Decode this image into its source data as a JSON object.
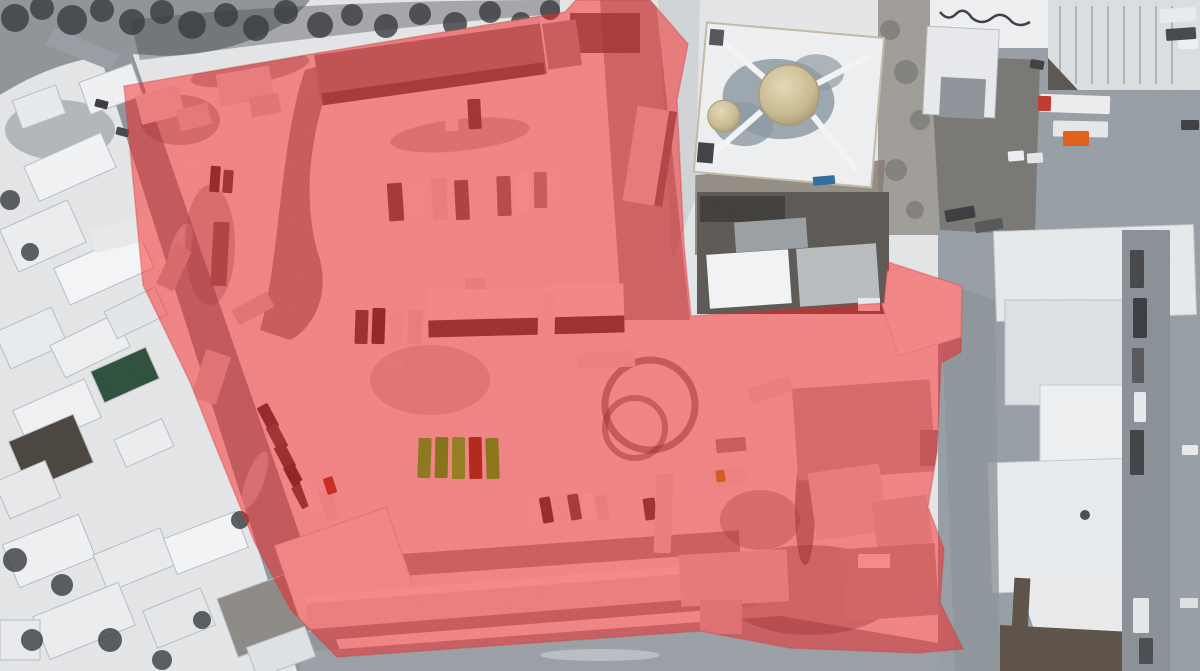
{
  "scene": {
    "kind": "aerial-drone-photo",
    "season": "winter-snow",
    "subject": "snow-covered vehicle depot compound highlighted with a red polygon overlay; mosque with tan dome at top, residential houses left, industrial warehouses right"
  },
  "annotation": {
    "zones": [
      {
        "id": "main-compound",
        "shape": "polygon",
        "color": "#ff1414",
        "edge": "#d03535",
        "opacity": 0.47,
        "points": "124,86 300,56 565,12 576,0 650,0 688,44 677,100 684,245 691,316 884,303 888,262 962,286 961,352 941,363 937,452 928,507 944,549 940,602 963,649 918,653 790,648 700,631 337,657 291,610 255,543 213,440 190,382 143,285"
      }
    ]
  },
  "palette": {
    "snow": "#e4e6e8",
    "road": "#8f969c",
    "roof_white": "#f0f2f4",
    "roof_gray": "#b9bdc0",
    "roof_dark": "#4a443e",
    "roof_green": "#2c4f3a",
    "dome_tan": "#cdbf9a",
    "tree_dark": "#35383c",
    "courtyard_brown": "#7b7267",
    "olive_truck": "#8c7720",
    "red_vehicle": "#cc2a1e",
    "orange_truck": "#e06018"
  },
  "vehicles": {
    "under": [
      [
        388,
        183,
        15,
        38,
        -4,
        "#56565a"
      ],
      [
        410,
        180,
        16,
        40,
        -4,
        "#e9e9eb"
      ],
      [
        432,
        178,
        15,
        42,
        -3,
        "#d8d8da"
      ],
      [
        455,
        180,
        14,
        40,
        -3,
        "#66666a"
      ],
      [
        476,
        178,
        15,
        42,
        -2,
        "#e4e4e6"
      ],
      [
        497,
        176,
        14,
        40,
        -2,
        "#77777b"
      ],
      [
        516,
        174,
        13,
        38,
        -2,
        "#ededef"
      ],
      [
        534,
        172,
        13,
        36,
        -1,
        "#98989c"
      ],
      [
        552,
        170,
        12,
        34,
        -1,
        "#e8e8ea"
      ],
      [
        445,
        103,
        13,
        28,
        -3,
        "#e6e6e8"
      ],
      [
        468,
        99,
        13,
        30,
        -3,
        "#4e4e52"
      ],
      [
        355,
        310,
        13,
        34,
        2,
        "#46464a"
      ],
      [
        372,
        308,
        13,
        36,
        2,
        "#343438"
      ],
      [
        390,
        312,
        13,
        32,
        2,
        "#e0e0e2"
      ],
      [
        408,
        310,
        14,
        34,
        2,
        "#d8d8da"
      ],
      [
        385,
        356,
        18,
        11,
        -4,
        "#cdcdcf"
      ],
      [
        538,
        293,
        17,
        44,
        1,
        "#e6e6e8"
      ],
      [
        577,
        352,
        58,
        16,
        -3,
        "#dededf"
      ],
      [
        262,
        404,
        12,
        26,
        -28,
        "#3a3a3e"
      ],
      [
        271,
        424,
        12,
        26,
        -28,
        "#4a4a4e"
      ],
      [
        279,
        444,
        12,
        26,
        -28,
        "#404044"
      ],
      [
        288,
        464,
        12,
        25,
        -28,
        "#2e2e32"
      ],
      [
        296,
        484,
        12,
        24,
        -28,
        "#46464a"
      ],
      [
        305,
        478,
        13,
        34,
        -20,
        "#eaeaec"
      ],
      [
        322,
        490,
        13,
        30,
        -20,
        "#dcdcde"
      ],
      [
        527,
        499,
        11,
        26,
        -10,
        "#e8e8ea"
      ],
      [
        541,
        497,
        11,
        26,
        -10,
        "#3c3c40"
      ],
      [
        555,
        495,
        11,
        26,
        -10,
        "#e2e2e4"
      ],
      [
        569,
        494,
        11,
        26,
        -10,
        "#58585c"
      ],
      [
        583,
        494,
        11,
        26,
        -10,
        "#eceef0"
      ],
      [
        597,
        495,
        11,
        25,
        -10,
        "#d8d8da"
      ],
      [
        630,
        500,
        12,
        22,
        -8,
        "#e6e6e8"
      ],
      [
        644,
        498,
        12,
        22,
        -8,
        "#48484c"
      ],
      [
        655,
        473,
        17,
        80,
        2,
        "#d9d9db"
      ],
      [
        712,
        468,
        34,
        18,
        -8,
        "#e0e0e2"
      ],
      [
        716,
        438,
        30,
        14,
        -5,
        "#9a9a9e"
      ],
      [
        748,
        382,
        44,
        16,
        -18,
        "#dadadc"
      ],
      [
        198,
        352,
        26,
        50,
        18,
        "#c9c9cb"
      ],
      [
        185,
        160,
        16,
        10,
        0,
        "#e8e8ea"
      ],
      [
        210,
        166,
        10,
        26,
        4,
        "#3a3a3e"
      ],
      [
        223,
        170,
        10,
        23,
        4,
        "#4c4c50"
      ],
      [
        212,
        222,
        16,
        64,
        3,
        "#6a6a6e"
      ],
      [
        233,
        300,
        40,
        17,
        -28,
        "#c8c8ca"
      ],
      [
        152,
        258,
        44,
        19,
        -65,
        "#b6b6b8"
      ]
    ],
    "accent": [
      [
        418,
        438,
        13,
        40,
        2,
        "#8c7720"
      ],
      [
        435,
        437,
        13,
        41,
        1,
        "#877218"
      ],
      [
        452,
        437,
        13,
        42,
        0,
        "#947f1f"
      ],
      [
        469,
        437,
        13,
        42,
        -1,
        "#b2271a"
      ],
      [
        486,
        438,
        13,
        41,
        -2,
        "#8a7519"
      ],
      [
        325,
        477,
        10,
        17,
        -18,
        "#cc2a1e"
      ],
      [
        716,
        470,
        9,
        12,
        -8,
        "#d4581e"
      ]
    ],
    "outside": [
      [
        92,
        222,
        62,
        24,
        -14,
        "#e9eaec"
      ],
      [
        1040,
        95,
        70,
        18,
        2,
        "#eceef0"
      ],
      [
        1038,
        96,
        13,
        15,
        2,
        "#c0392b"
      ],
      [
        1053,
        121,
        55,
        16,
        1,
        "#e6e8ea"
      ],
      [
        1063,
        131,
        26,
        15,
        0,
        "#e06018"
      ],
      [
        1008,
        151,
        16,
        10,
        -4,
        "#eef0f2"
      ],
      [
        1027,
        153,
        16,
        10,
        -4,
        "#e4e6e8"
      ],
      [
        1030,
        60,
        14,
        9,
        10,
        "#3e4044"
      ],
      [
        945,
        208,
        30,
        12,
        -10,
        "#3a3c40"
      ],
      [
        975,
        220,
        28,
        11,
        -10,
        "#54565a"
      ],
      [
        1130,
        250,
        14,
        38,
        0,
        "#44464a"
      ],
      [
        1133,
        298,
        14,
        40,
        0,
        "#3a3c40"
      ],
      [
        1132,
        348,
        12,
        35,
        0,
        "#55575b"
      ],
      [
        1134,
        392,
        12,
        30,
        0,
        "#e8eaec"
      ],
      [
        1130,
        430,
        14,
        45,
        0,
        "#404246"
      ],
      [
        1133,
        598,
        16,
        35,
        0,
        "#e6e8ea"
      ],
      [
        1139,
        638,
        14,
        26,
        0,
        "#4a4c50"
      ],
      [
        1178,
        38,
        20,
        11,
        0,
        "#eef0f2"
      ],
      [
        1181,
        120,
        18,
        10,
        0,
        "#3c3e42"
      ],
      [
        1182,
        445,
        16,
        10,
        0,
        "#e8eaec"
      ],
      [
        1180,
        598,
        18,
        10,
        0,
        "#dfe1e3"
      ],
      [
        1160,
        8,
        36,
        14,
        -4,
        "#e9ebed"
      ],
      [
        1166,
        28,
        30,
        12,
        -4,
        "#45474b"
      ],
      [
        95,
        100,
        13,
        8,
        15,
        "#3a3c40"
      ],
      [
        116,
        128,
        13,
        8,
        15,
        "#44464a"
      ],
      [
        813,
        176,
        22,
        9,
        -5,
        "#2e6f9e"
      ]
    ]
  }
}
